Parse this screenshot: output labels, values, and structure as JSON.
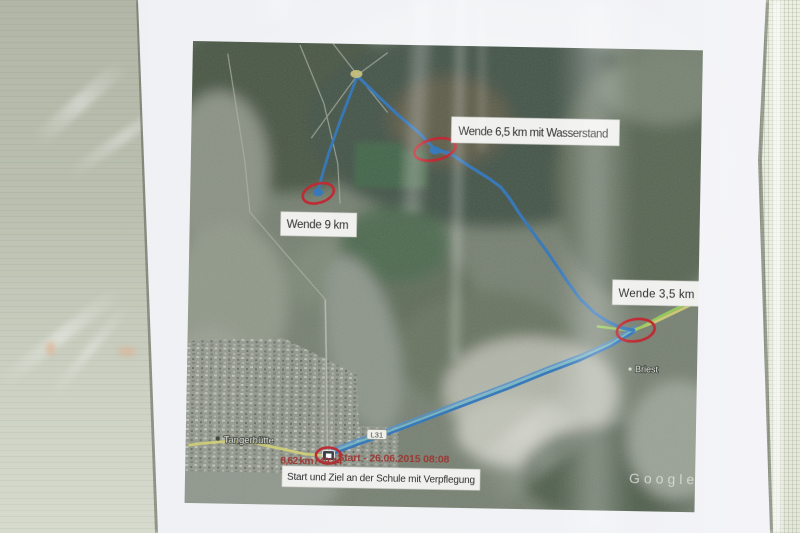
{
  "map": {
    "labels": {
      "wende_65": "Wende 6,5 km mit Wasserstand",
      "wende_9": "Wende 9 km",
      "wende_35": "Wende 3,5 km",
      "start_ziel": "Start und Ziel an der Schule mit Verpflegung"
    },
    "gps": {
      "start_info": "Start - 26.06.2015 08:08",
      "track_stats": "8,62 km / 49:44"
    },
    "places": {
      "town": "Tangerhütte",
      "village": "Briest",
      "road_shield": "L31"
    },
    "watermark": "Google",
    "routes": {
      "main": "165,32 183,49 205,69 227,87 243,103 260,108 277,119 297,131 310,140 319,151 329,166 344,186 357,203 367,217 379,234 392,251 407,265 420,273 434,279 446,281",
      "spur": "165,32 157,54 148,79 138,109 131,134 128,147",
      "return": "446,283 424,297 393,312 358,326 323,341 288,355 258,367 228,379 198,391 173,400 153,408 144,412",
      "road": "508,252 468,272 446,281 424,296 393,311 358,325 323,340 288,354 258,366 228,378 198,390 173,399 152,408 137,412 120,411 95,406 65,400 38,400 18,402 4,404",
      "green": "410,278 446,282 472,267 505,250"
    },
    "colors": {
      "track_blue": "#2d7ac8",
      "track_blue_light": "#4a94d8",
      "track_cyan": "#62bce0",
      "road_yellow": "#d6d46a",
      "track_green": "#94d24e",
      "marker_red": "#d0242f",
      "gps_text_red": "#a8332e"
    }
  }
}
